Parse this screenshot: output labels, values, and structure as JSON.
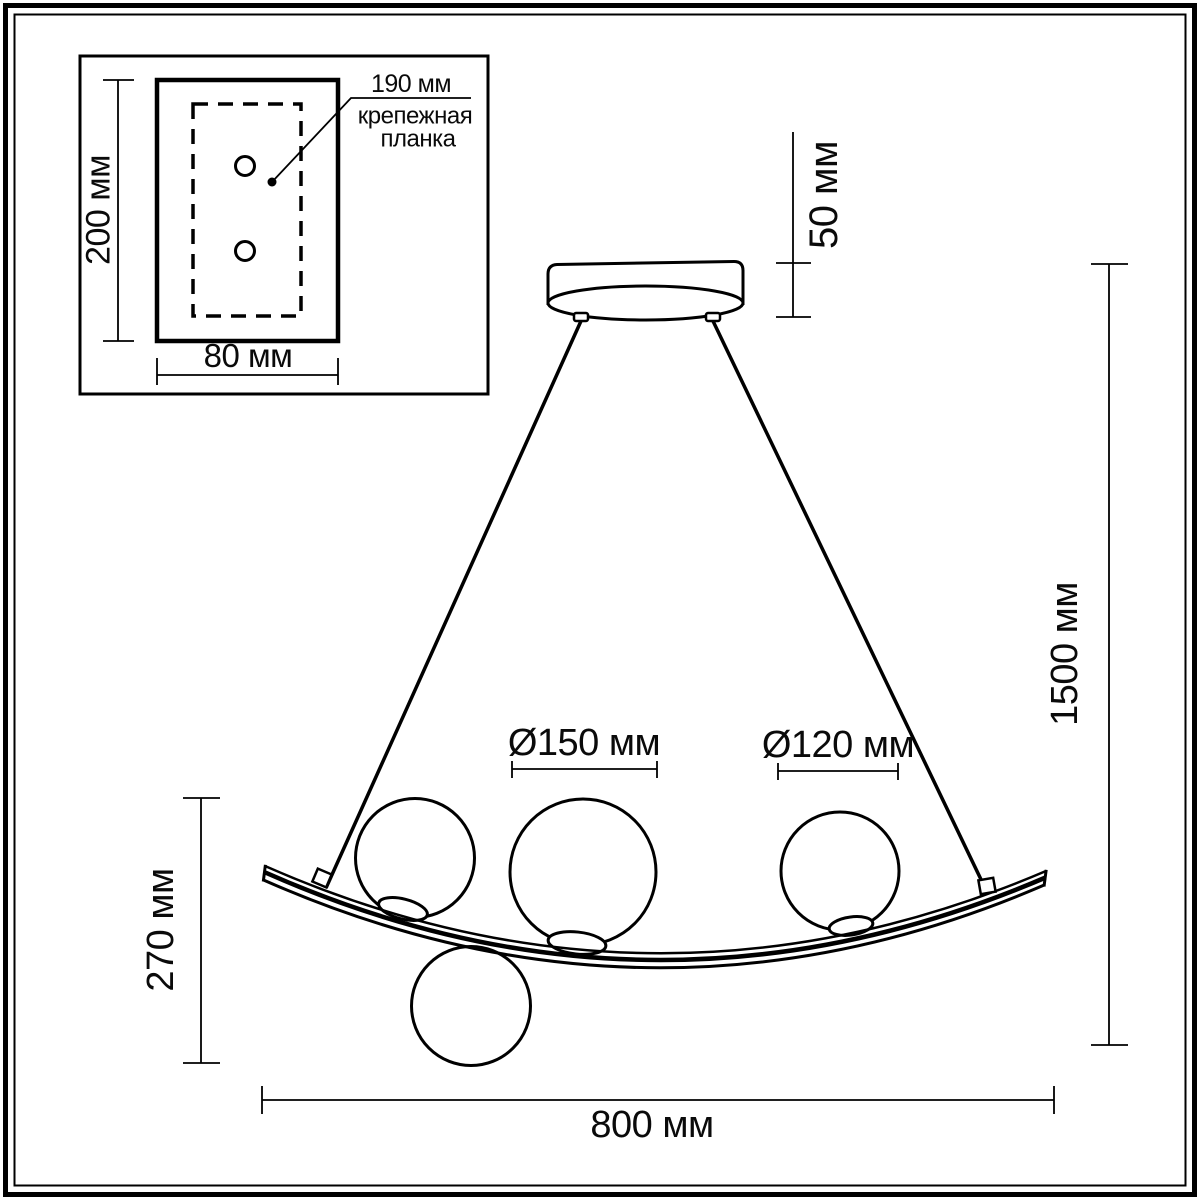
{
  "inset": {
    "plate_height": "200 мм",
    "plate_width": "80 мм",
    "bar_length": "190 мм",
    "bar_label_line1": "крепежная",
    "bar_label_line2": "планка"
  },
  "fixture": {
    "canopy_height": "50 мм",
    "overall_height": "1500 мм",
    "body_height": "270 мм",
    "body_width": "800 мм",
    "globe_large_diameter": "Ø150 мм",
    "globe_small_diameter": "Ø120 мм"
  },
  "colors": {
    "line": "#000000",
    "background": "#ffffff"
  }
}
